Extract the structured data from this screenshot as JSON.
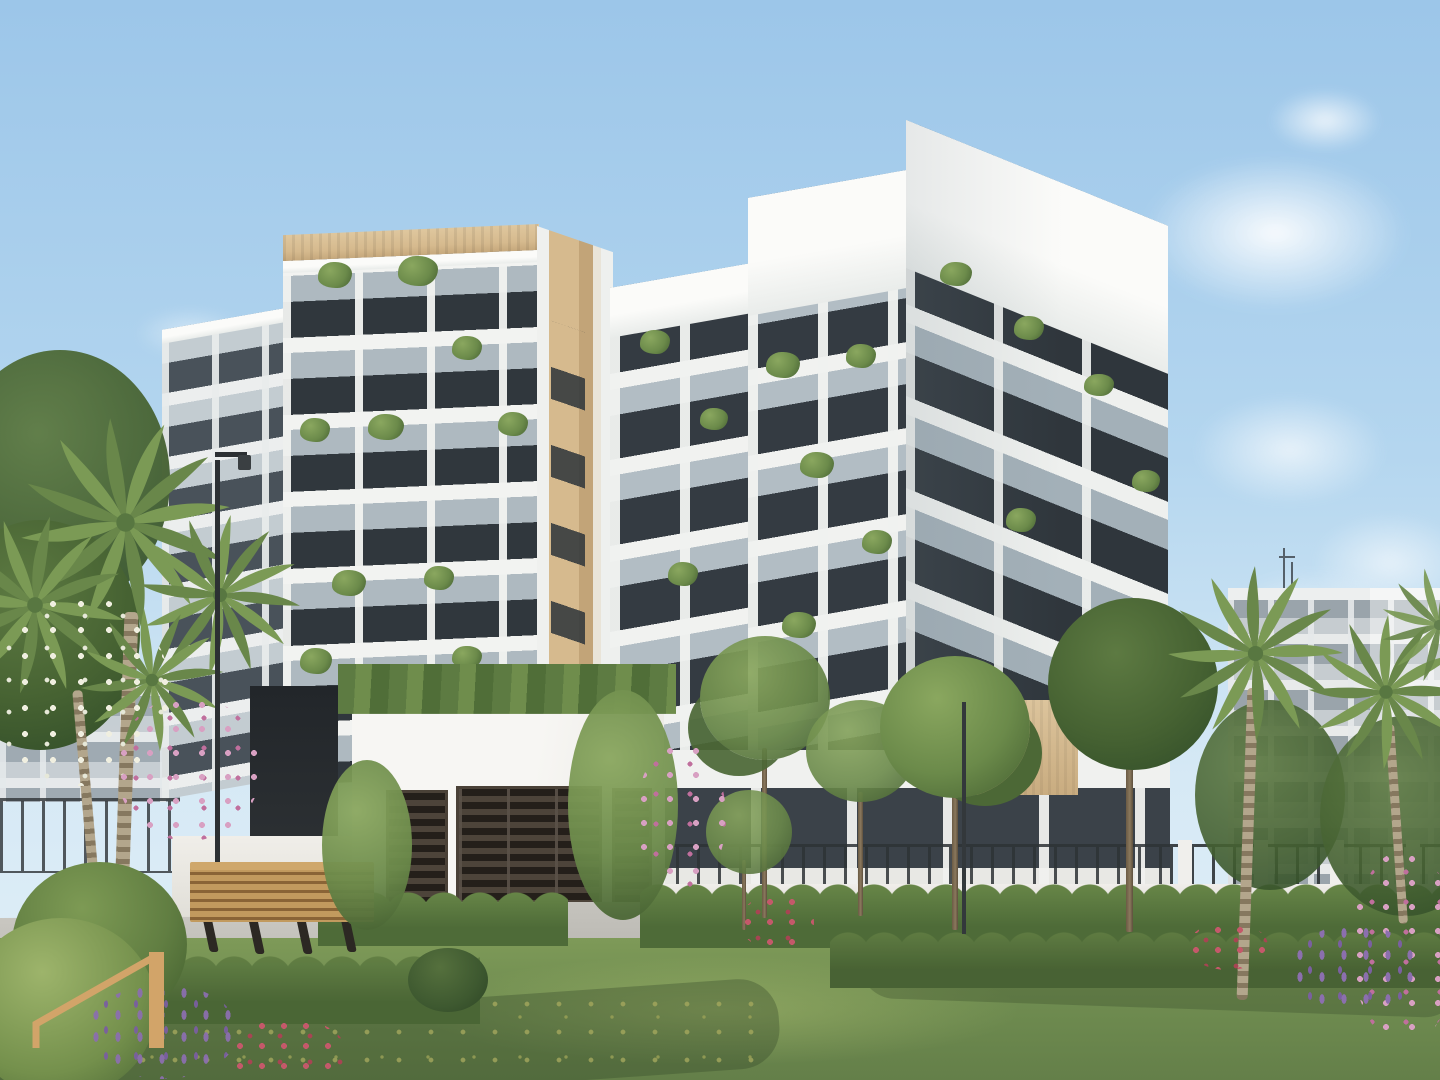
{
  "meta": {
    "title": "Architectural rendering of a modern white residential complex with landscaped gardens, palm trees and a lawn",
    "image_type": "3D exterior render"
  },
  "palette": {
    "sky_top": "#9cc6e9",
    "sky_mid": "#b4d6ef",
    "sky_low": "#d6e9f5",
    "white_hi": "#fbfbf9",
    "white": "#f2f3f1",
    "white_shade": "#e3e6e4",
    "glass": "#aeb9c0",
    "window": "#30373d",
    "window_light": "#49525a",
    "stone": "#d6ba8e",
    "stone_dark": "#c2a478",
    "leaf": "#6b8a4a",
    "leaf_dark": "#4c6836",
    "leaf_light": "#8aa75f",
    "hedge": "#4e6b38",
    "lawn": "#7b9756",
    "lawn_light": "#93ad63",
    "lawn_shadow": "#5d7a45",
    "wood": "#b88f55",
    "louver": "#241f1a",
    "louver_light": "#4d443a",
    "path": "#c2c0ba",
    "sand": "#cdbb9e",
    "metal": "#2e3336",
    "bg_building": "#ccd2d6",
    "gold": "#d2a469"
  },
  "watermark": {
    "name": "developer-logo-mark",
    "shape": "angular gold monogram (peaked line with vertical bar)",
    "color": "#d2a469"
  },
  "scene": {
    "sky": "clear light-blue sky with soft white clouds at upper right",
    "left_building": {
      "floors": 7,
      "features": "white balcony slabs, glass balustrades, dark glazing, beige stone parapet, balcony plants"
    },
    "right_building": {
      "floors": 8,
      "features": "stepped white corner tower, wrap-around balconies, balcony plants, stone accent wall at ground level"
    },
    "entrance": {
      "structure": "white gatehouse",
      "gate": "dark horizontal louvre gate",
      "side_panels": 2,
      "roof": "cascading green planting over the edge"
    },
    "background": {
      "right": "grey low-rise block with window grid and rooftop antenna",
      "left": "low grey building behind palms"
    },
    "garden": {
      "lawn": "sunlit lawn with small yellow wildflowers and tree shadows",
      "hedges": "clipped scalloped hedge rows along white plinth fence with pillars",
      "palm_crowns_left": 4,
      "palm_crowns_right": 3,
      "ornamental_trees": 5,
      "bench": "timber slat bench on concrete plinth",
      "lamp_posts": 2,
      "flower_colors": [
        "pink",
        "purple",
        "white",
        "red"
      ]
    }
  }
}
